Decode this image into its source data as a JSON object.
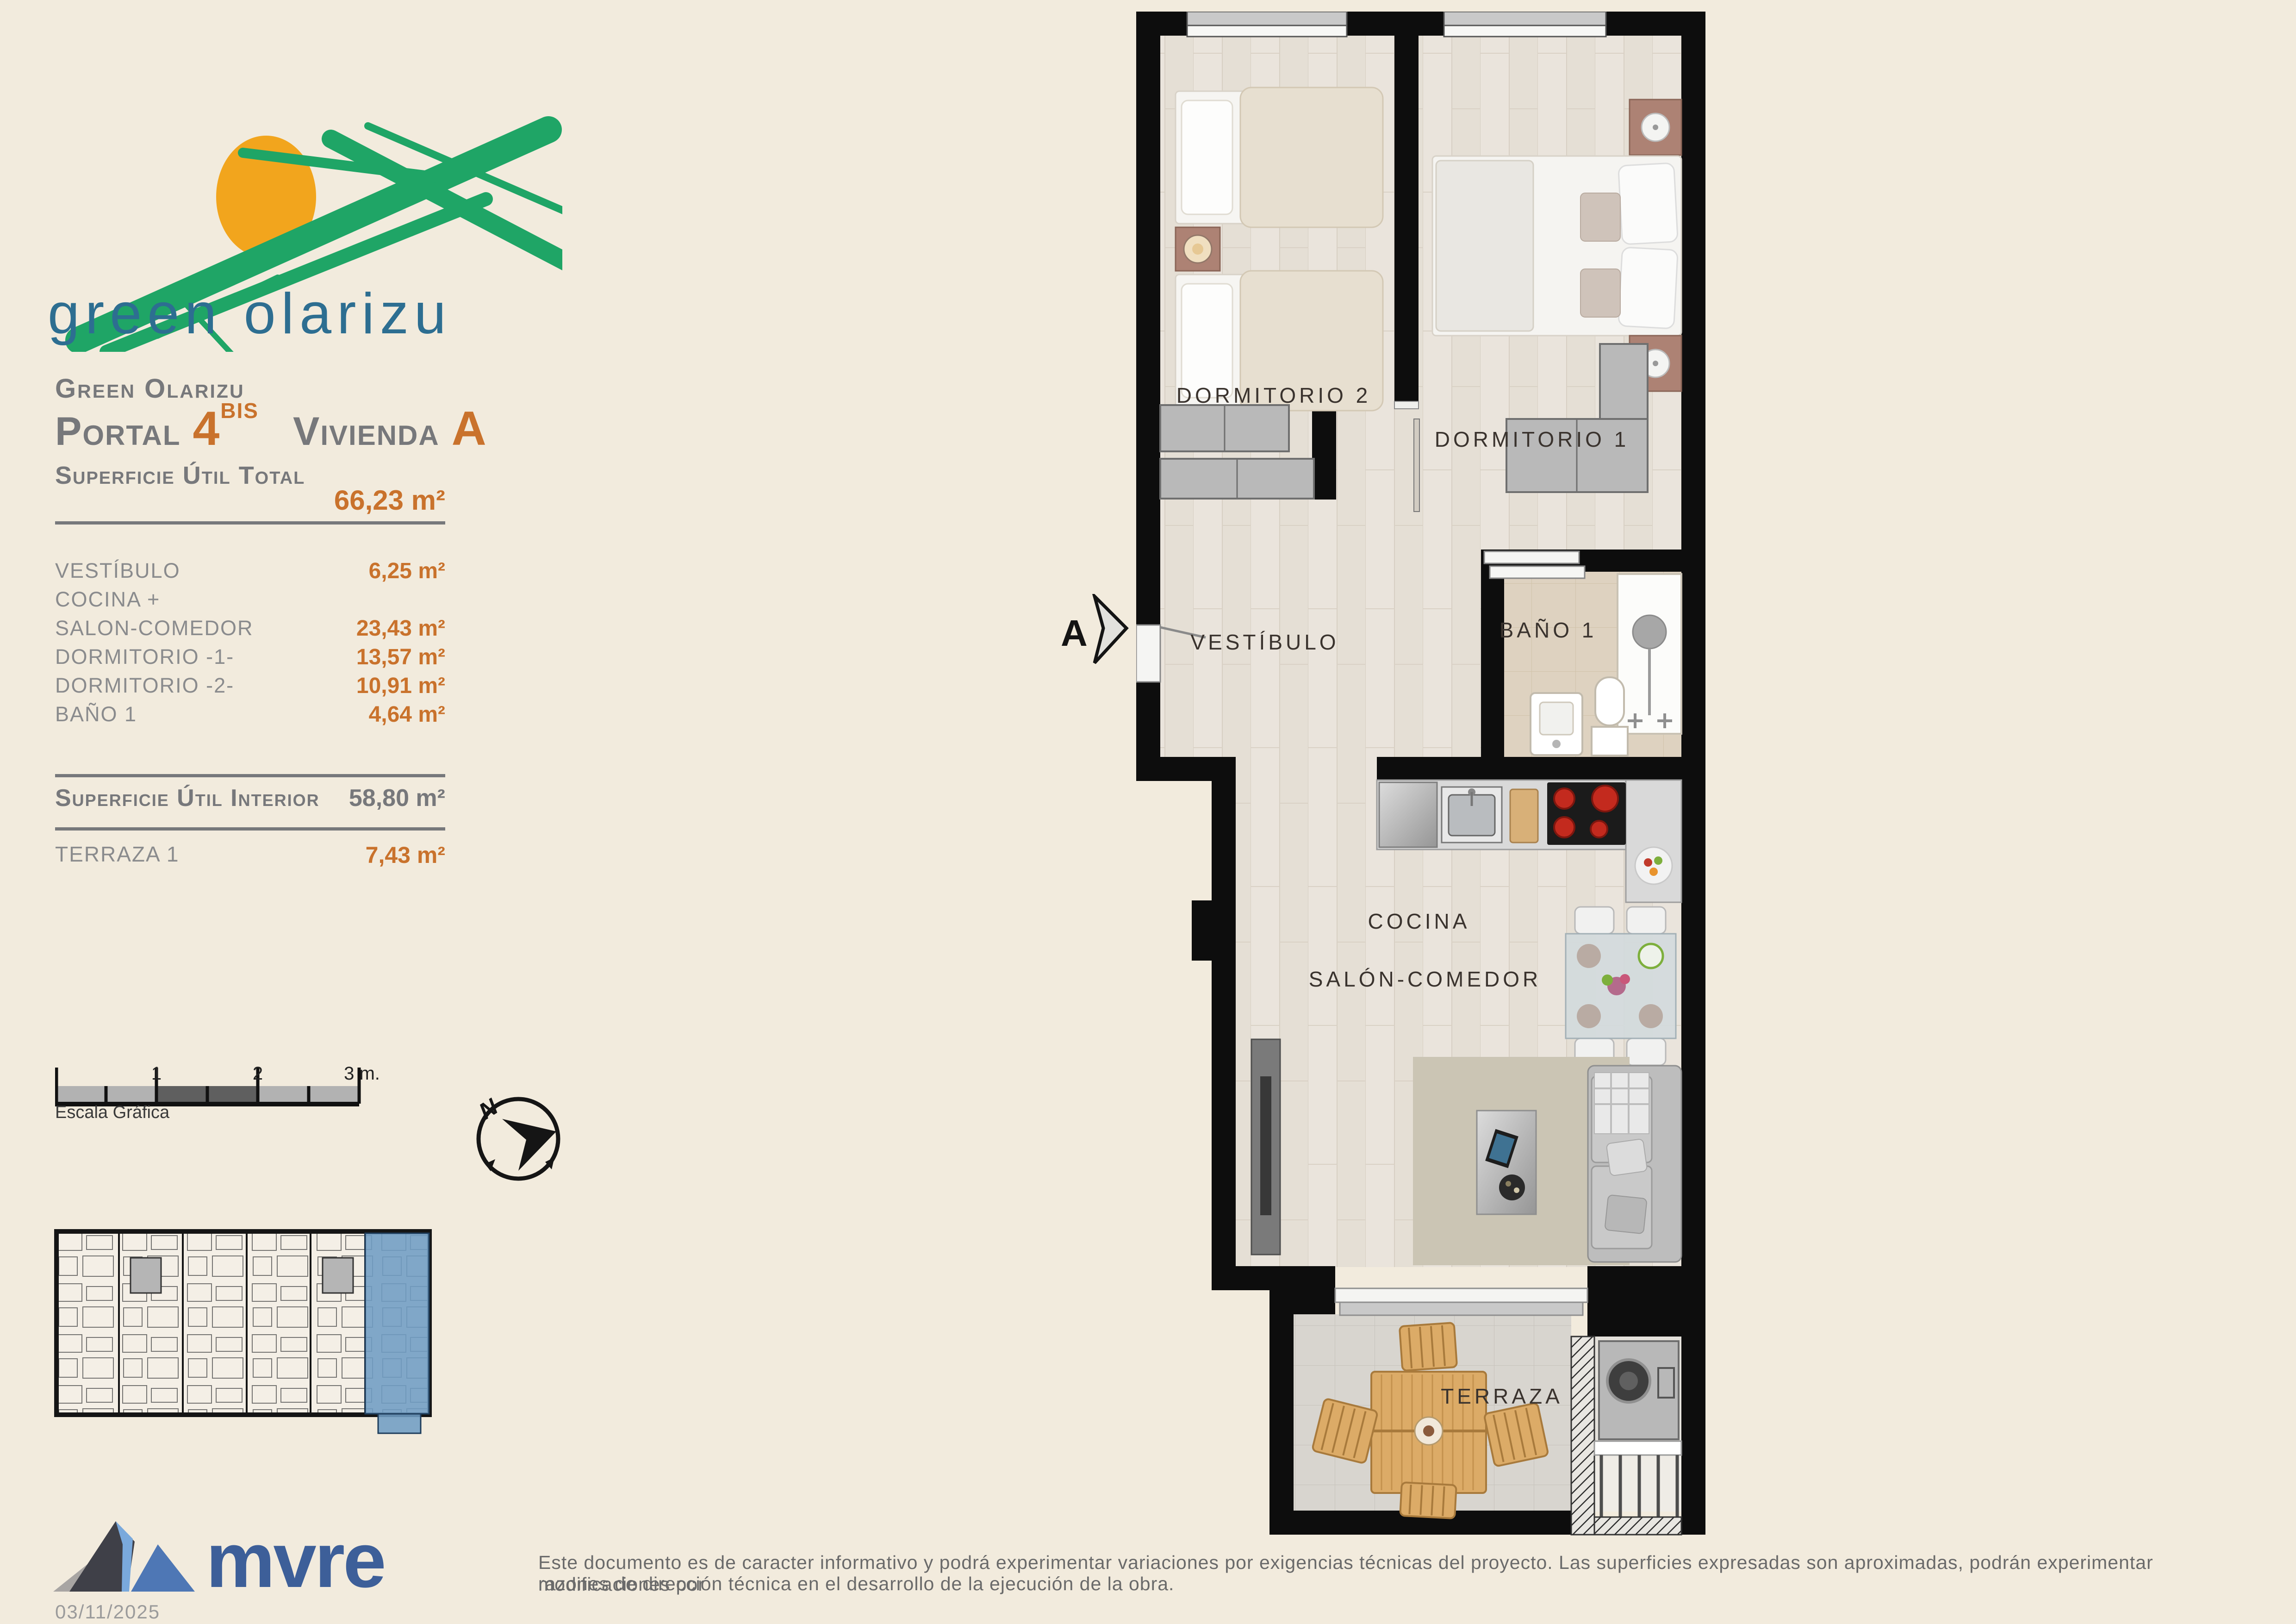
{
  "page": {
    "background": "#f2ebdd"
  },
  "logo": {
    "wordmark": "green olarizu",
    "brush_color": "#1fa566",
    "sun_color": "#f2a51d",
    "text_color": "#2d6e91"
  },
  "title_block": {
    "project": "Green Olarizu",
    "portal_label": "Portal",
    "portal_number": "4",
    "portal_superscript": "BIS",
    "vivienda_label": "Vivienda",
    "vivienda_letter": "A",
    "total_label": "Superficie Útil Total",
    "total_value": "66,23 m²"
  },
  "surfaces": {
    "rows": [
      {
        "label": "VESTÍBULO",
        "value": "6,25 m²"
      },
      {
        "label": "COCINA +",
        "value": ""
      },
      {
        "label": "SALON-COMEDOR",
        "value": "23,43 m²"
      },
      {
        "label": "DORMITORIO -1-",
        "value": "13,57 m²"
      },
      {
        "label": "DORMITORIO -2-",
        "value": "10,91 m²"
      },
      {
        "label": "BAÑO 1",
        "value": "4,64 m²"
      }
    ],
    "interior_label": "Superficie Útil Interior",
    "interior_value": "58,80 m²",
    "terraza_label": "TERRAZA 1",
    "terraza_value": "7,43 m²"
  },
  "scale_bar": {
    "tick1": "1",
    "tick2": "2",
    "tick3": "3 m.",
    "caption": "Escala Gráfica"
  },
  "compass": {
    "north": "N"
  },
  "plan": {
    "section_marker": "A",
    "labels": {
      "dormitorio2": "DORMITORIO 2",
      "dormitorio1": "DORMITORIO 1",
      "vestibulo": "VESTÍBULO",
      "bano1": "BAÑO 1",
      "cocina": "COCINA",
      "salon": "SALÓN-COMEDOR",
      "terraza": "TERRAZA"
    },
    "colors": {
      "wall": "#0d0d0d",
      "wood_floor": "#e9e3da",
      "bath_floor": "#ded2c0",
      "terrace_floor": "#d8d5cf",
      "highlight_blue": "#6f9dc4"
    }
  },
  "footer": {
    "brand": "mvre",
    "brand_color": "#3d5f99",
    "disclaimer_line1": "Este documento es de caracter informativo y podrá experimentar variaciones por exigencias técnicas del proyecto. Las superficies expresadas son aproximadas, podrán experimentar modificaciones por",
    "disclaimer_line2": "razones de dirección técnica en el desarrollo de la ejecución de la obra.",
    "date": "03/11/2025"
  },
  "accent_colors": {
    "orange": "#c9722c",
    "gray": "#77787b"
  }
}
